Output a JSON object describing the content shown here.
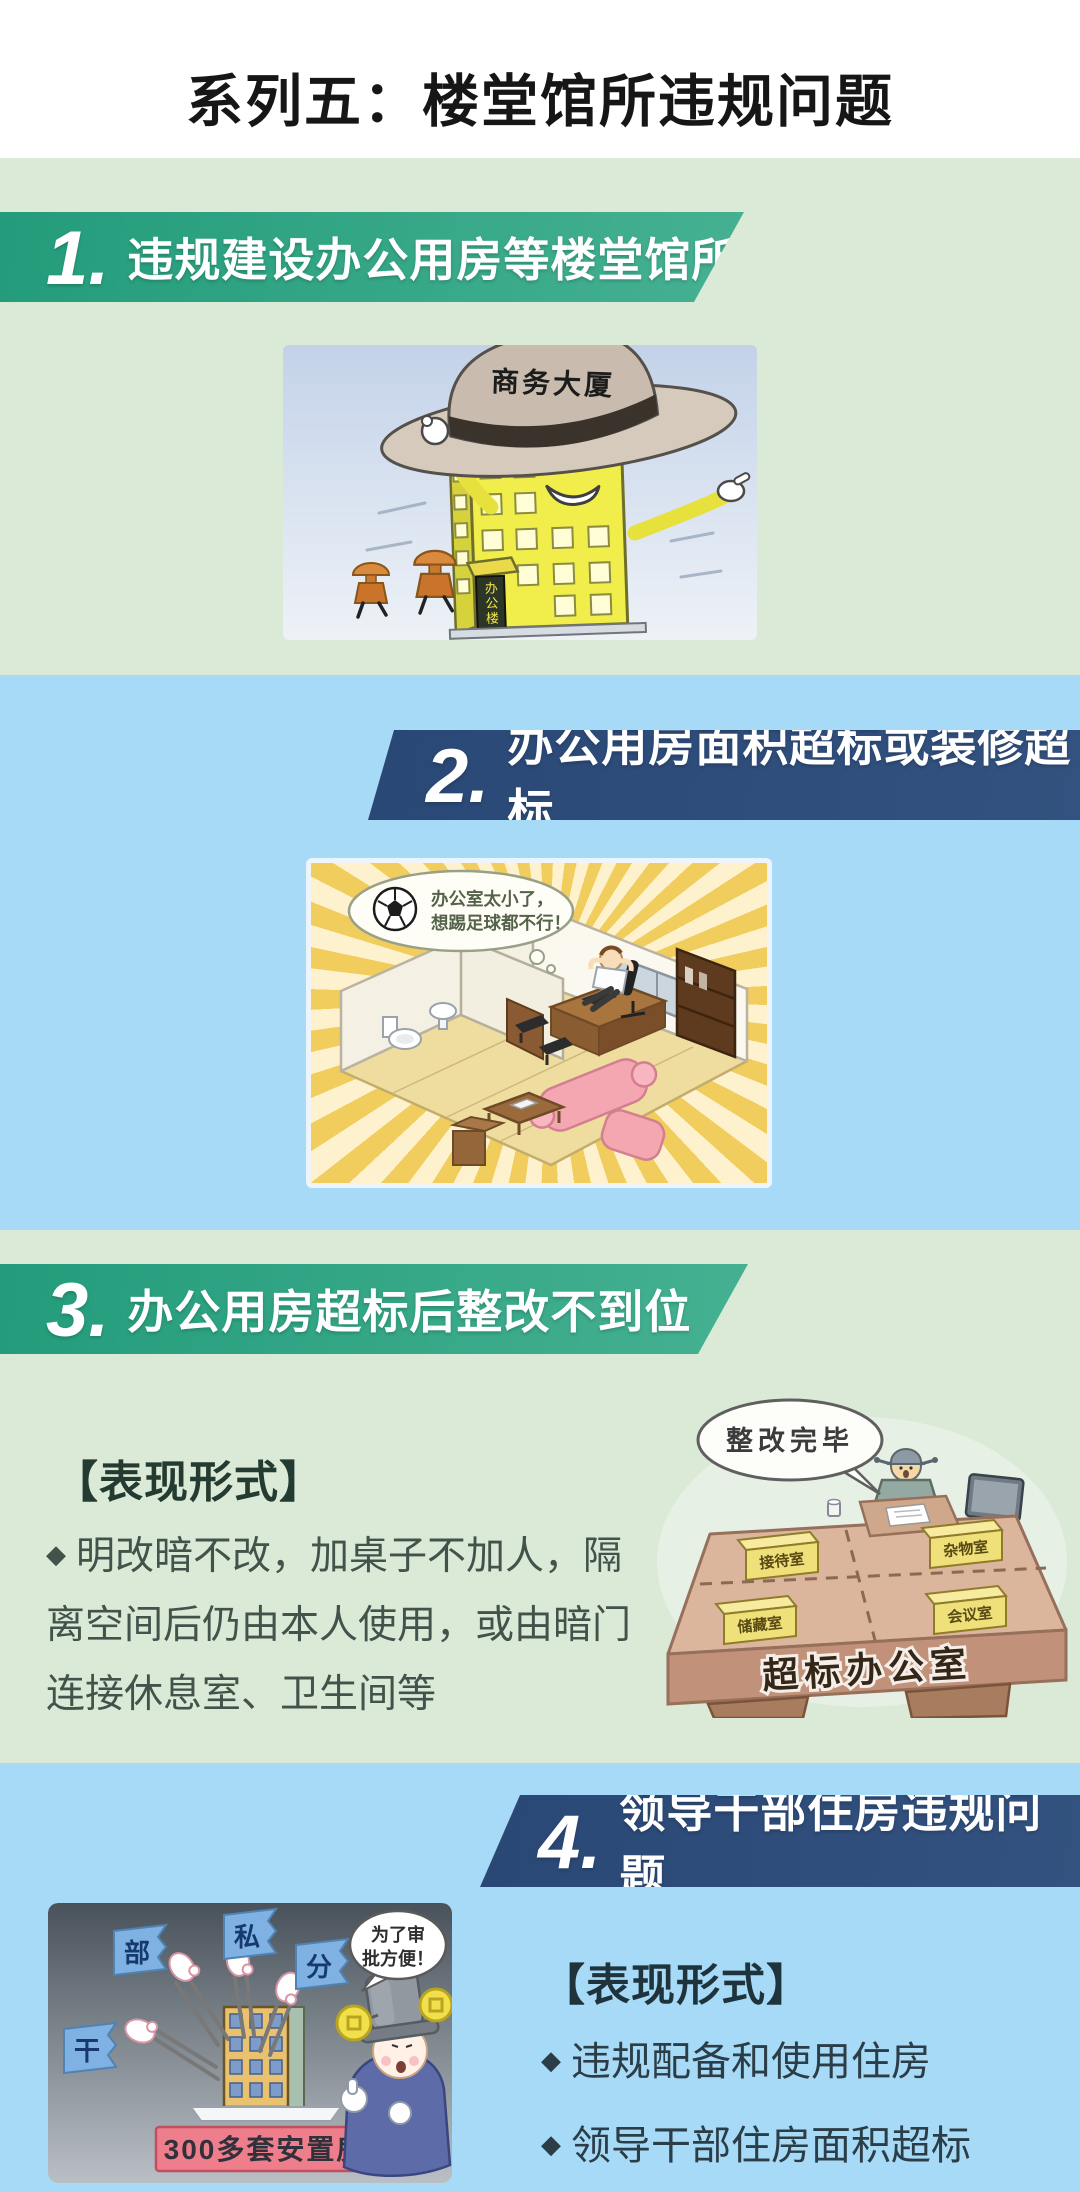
{
  "page_title": "系列五：楼堂馆所违规问题",
  "colors": {
    "header_bg": "#ffffff",
    "title_text": "#161616",
    "green_section_bg": "#dbe9d7",
    "blue_section_bg": "#a7daf6",
    "banner_green_start": "#239c7b",
    "banner_green_end": "#45b192",
    "banner_navy_start": "#2a4876",
    "banner_navy_end": "#33527f",
    "banner_text": "#ffffff",
    "heading_text_green": "#233b31",
    "heading_text_blue": "#1f333d",
    "body_text_green": "#43534b",
    "body_text_blue": "#2b3d47"
  },
  "sections": [
    {
      "number": "1.",
      "title": "违规建设办公用房等楼堂馆所",
      "illustration": {
        "hat_label": "商务大厦",
        "building_sign": "办公楼"
      }
    },
    {
      "number": "2.",
      "title": "办公用房面积超标或装修超标",
      "illustration": {
        "speech_line1": "办公室太小了，",
        "speech_line2": "想踢足球都不行！"
      }
    },
    {
      "number": "3.",
      "title": "办公用房超标后整改不到位",
      "forms_heading": "【表现形式】",
      "bullet_marker": "◆",
      "bullet_text": "明改暗不改，加桌子不加人，隔离空间后仍由本人使用，或由暗门连接休息室、卫生间等",
      "illustration": {
        "speech": "整改完毕",
        "desk_label": "超标办公室",
        "signs": [
          "接待室",
          "杂物室",
          "储藏室",
          "会议室"
        ]
      }
    },
    {
      "number": "4.",
      "title": "领导干部住房违规问题",
      "forms_heading": "【表现形式】",
      "bullet_marker": "◆",
      "bullets": [
        "违规配备和使用住房",
        "领导干部住房面积超标"
      ],
      "illustration": {
        "flags": [
          "干",
          "部",
          "私",
          "分"
        ],
        "plate_label": "300多套安置房",
        "speech_line1": "为了审",
        "speech_line2": "批方便！"
      }
    }
  ]
}
